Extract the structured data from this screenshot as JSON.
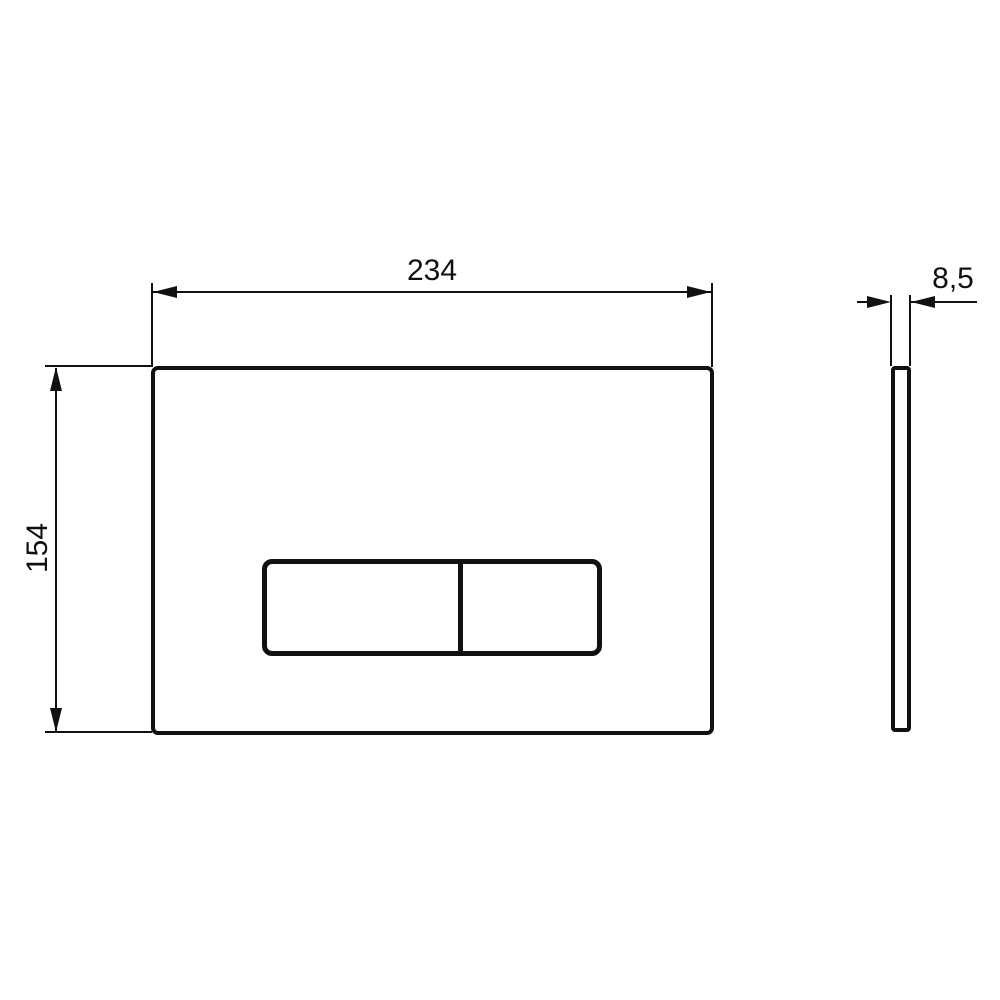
{
  "labels": {
    "width": "234",
    "height": "154",
    "thickness": "8,5"
  },
  "colors": {
    "line": "#111111",
    "background": "#ffffff"
  },
  "drawing": {
    "type": "technical-dimension-drawing",
    "views": [
      {
        "name": "front-view",
        "features": [
          "plate-outline",
          "dual-flush-button-panel",
          "button-divider"
        ]
      },
      {
        "name": "side-view",
        "features": [
          "thin-profile-outline"
        ]
      }
    ],
    "dimensions": [
      {
        "label": "234",
        "orientation": "horizontal",
        "applies_to": "plate-width"
      },
      {
        "label": "154",
        "orientation": "vertical",
        "applies_to": "plate-height"
      },
      {
        "label": "8,5",
        "orientation": "horizontal",
        "applies_to": "plate-thickness"
      }
    ]
  }
}
